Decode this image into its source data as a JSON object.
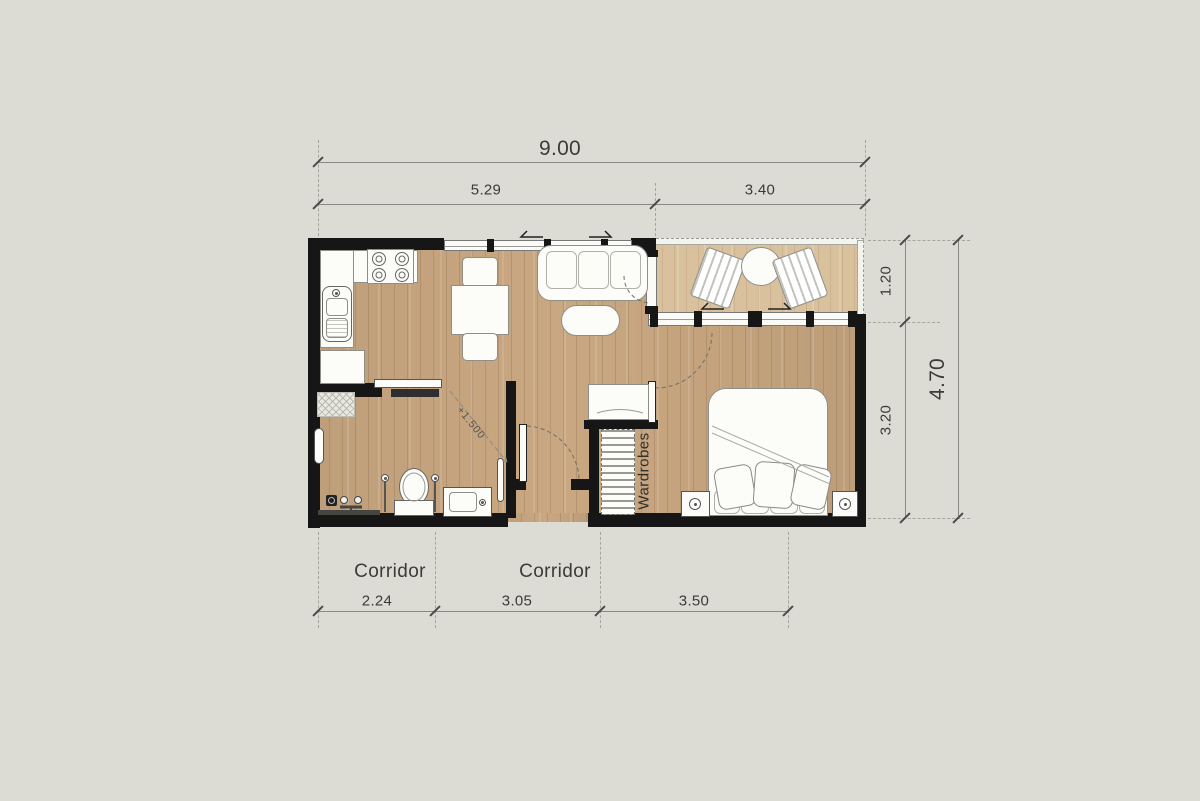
{
  "plan": {
    "dimensions": {
      "top": {
        "total": "9.00",
        "segments": [
          "5.29",
          "3.40"
        ]
      },
      "right": {
        "total": "4.70",
        "segments": [
          "1.20",
          "3.20"
        ]
      },
      "bottom": {
        "values": [
          "2.24",
          "3.05",
          "3.50"
        ],
        "corridor_label_1": "Corridor",
        "corridor_label_2": "Corridor"
      }
    },
    "annotations": {
      "wardrobes": "Wardrobes",
      "level": "+1.500"
    },
    "colors": {
      "background": "#dcdcd5",
      "wall": "#161616",
      "floor_wood": "#c9a781",
      "balcony_wood": "#d9c19d",
      "dimension_line": "#8a8a85",
      "text": "#3b3b38"
    }
  }
}
